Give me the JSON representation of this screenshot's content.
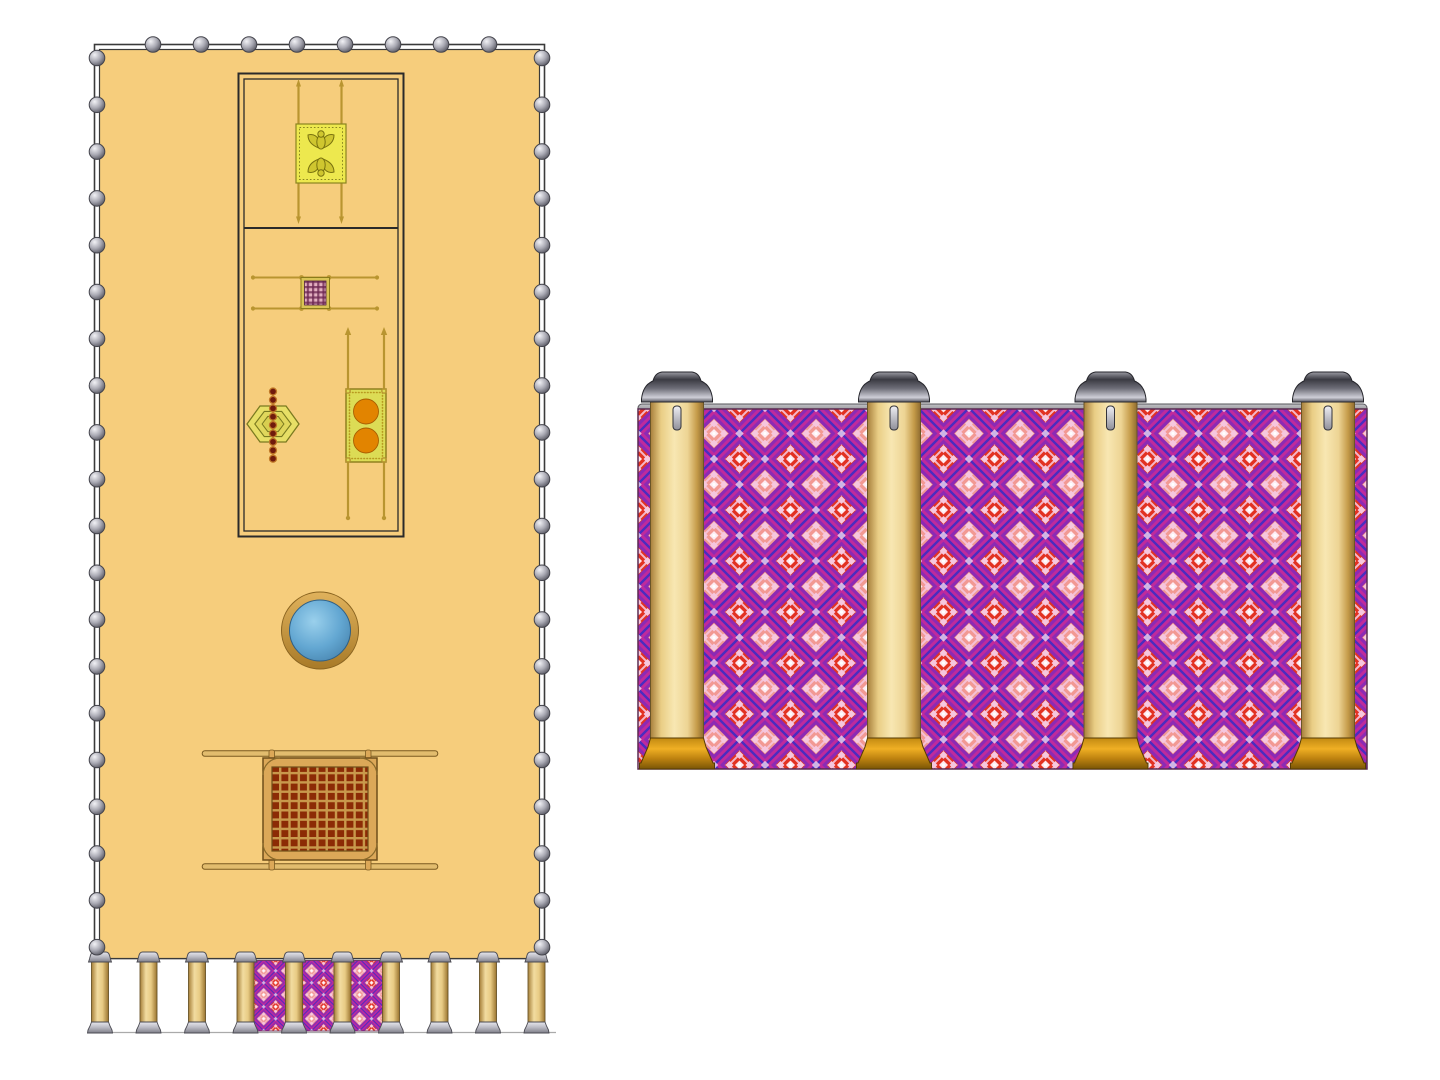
{
  "illustration": {
    "subject": "tabernacle-courtyard-plan-and-gate-elevation",
    "visible_text": []
  },
  "palette": {
    "canvas": "#ffffff",
    "court": "#F6CD7C",
    "outline": "#3A3A3A",
    "tent_line": "#2A2A2A",
    "gold": "#B99530",
    "gold_dark": "#8A7A1A",
    "ark_yellow": "#EDE84E",
    "ark_line": "#8A8420",
    "cherub_fill": "#CFC62F",
    "cherub_line": "#79720F",
    "plaid_pink": "#E3AFC0",
    "plaid_purple": "#6B2550",
    "menorah_yellow": "#E7DF66",
    "menorah_line": "#7A7A20",
    "lamp_red": "#701A0C",
    "lamp_rim": "#C07828",
    "incense_fill": "#DCDC55",
    "orange": "#E28400",
    "orange_line": "#A85E00",
    "altar_frame": "#DCA858",
    "altar_grid": "#C9994C",
    "altar_red": "#8C2B05",
    "pole_tan": "#E2BC6E",
    "pole_edge": "#7A5A20",
    "salmon": "#F08A7A",
    "red": "#E02818",
    "magenta": "#C02A9C",
    "purple": "#8C2AB4",
    "violet": "#4A2CC0",
    "pink": "#F6C6DE",
    "pink_light": "#FFF0F8",
    "curtain_edge": "#5A2A50",
    "ground": "#AAAAAA"
  },
  "plan": {
    "fence": {
      "top_post_count": 8,
      "side_post_count": 20,
      "top_xs": [
        153,
        201,
        249,
        297,
        345,
        393,
        441,
        489
      ],
      "top_y": 44.5,
      "left_x": 97,
      "right_x": 542,
      "side_y_start": 58,
      "side_y_step": 46.8
    },
    "rooms": 2,
    "furniture_count": 6,
    "gate": {
      "pillar_count": 10,
      "pillar_xs": [
        100,
        148.5,
        197,
        245.5,
        294,
        342.5,
        391,
        439.5,
        488,
        536.5
      ],
      "pillar_top_y": 952,
      "curtain_panel_count": 3
    }
  },
  "elevation": {
    "pillar_count": 4,
    "pillar_xs": [
      677,
      894,
      1110.5,
      1328
    ],
    "pillar_top_y": 372
  }
}
